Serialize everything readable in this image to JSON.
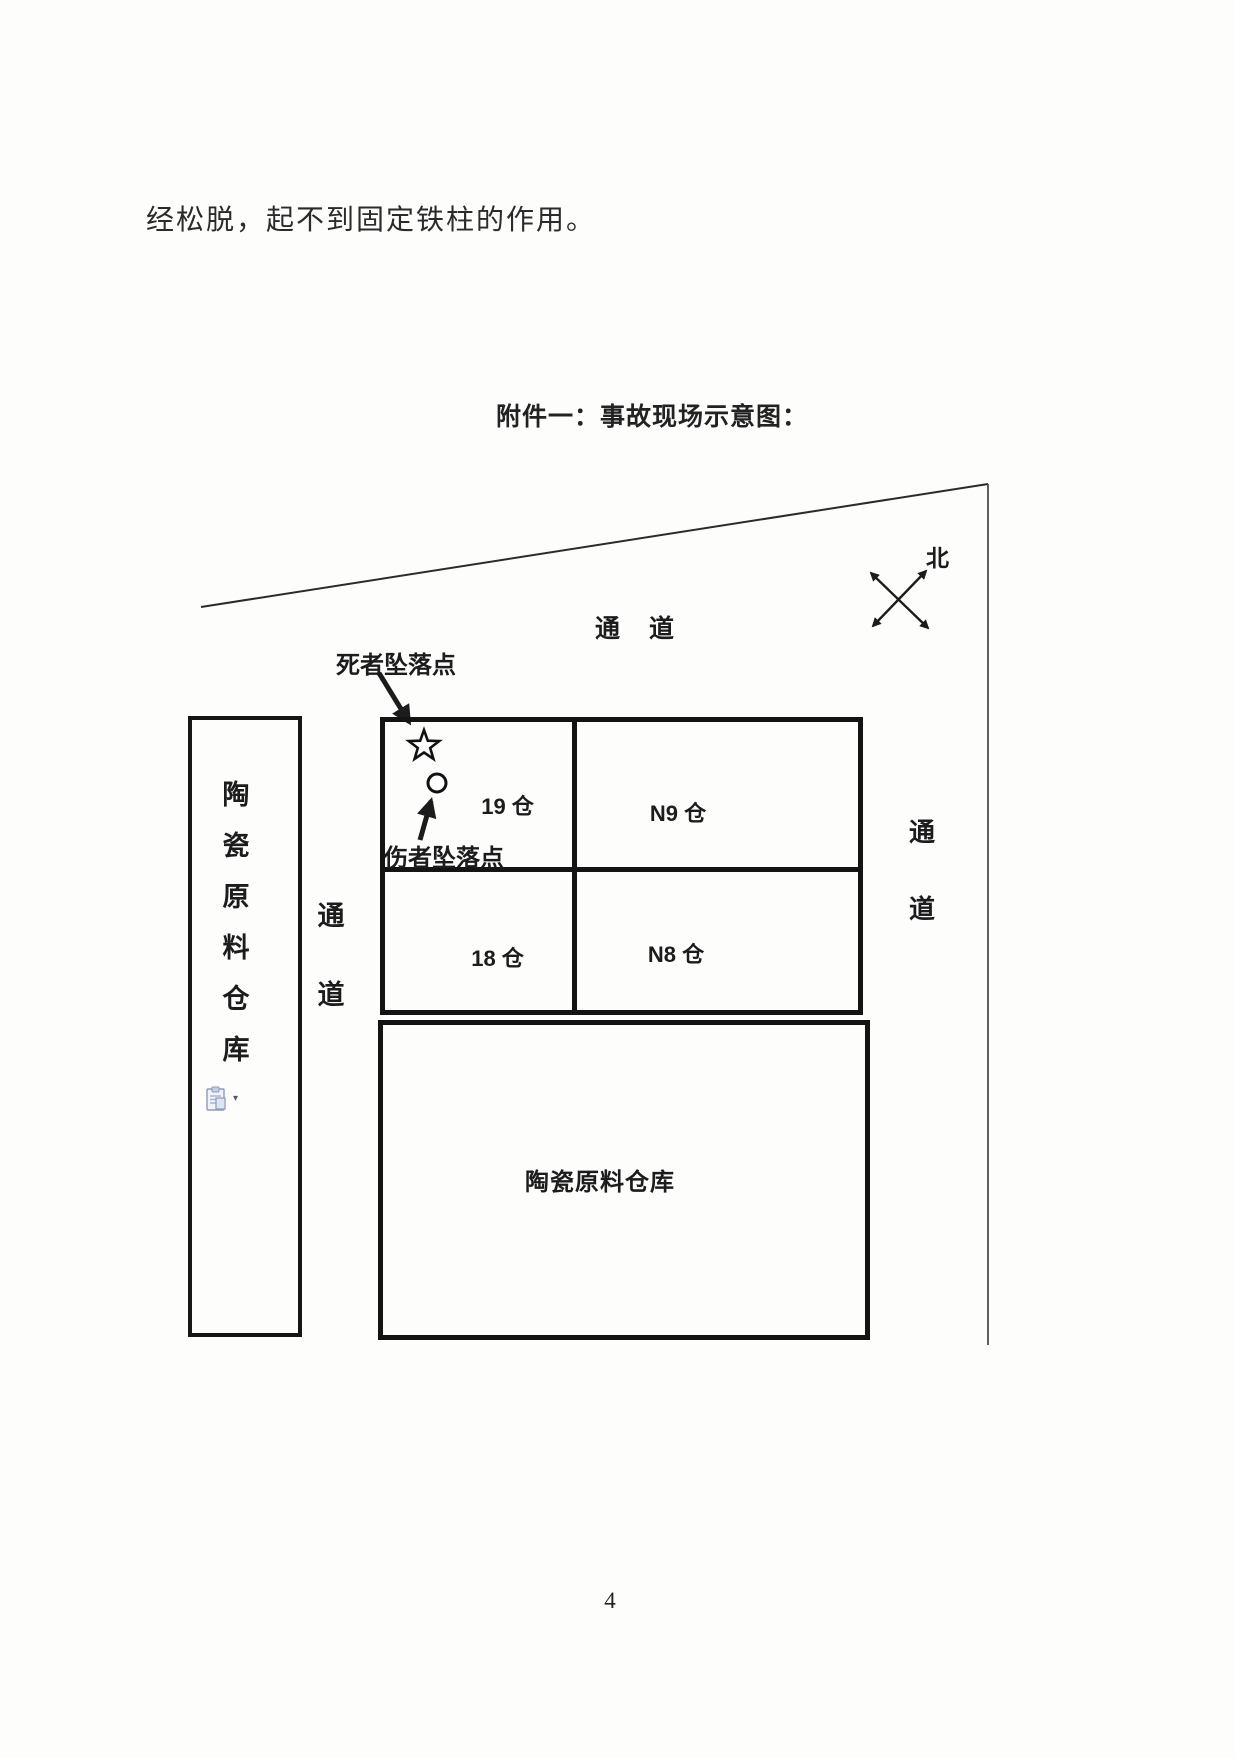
{
  "page": {
    "body_text": "经松脱，起不到固定铁柱的作用。",
    "page_number": "4"
  },
  "diagram": {
    "title": "附件一：事故现场示意图：",
    "north_label": "北",
    "top_aisle": "通　道",
    "deceased_fall_point": "死者坠落点",
    "injured_fall_point": "伤者坠落点",
    "left_warehouse_chars": [
      "陶",
      "瓷",
      "原",
      "料",
      "仓",
      "库"
    ],
    "middle_aisle_chars": [
      "通",
      "道"
    ],
    "right_aisle_chars": [
      "通",
      "道"
    ],
    "bins": {
      "b19": "19 仓",
      "n9": "N9 仓",
      "b18": "18 仓",
      "n8": "N8 仓"
    },
    "bottom_warehouse": "陶瓷原料仓库",
    "icons": {
      "deceased_marker": "star-outline",
      "injured_marker": "circle-outline",
      "compass": "four-way-arrows",
      "paste_options": "paste-options-clipboard",
      "dropdown": "▾"
    },
    "colors": {
      "ink": "#1f1f1f",
      "line": "#2b2b2b",
      "box_border": "#141414"
    }
  }
}
